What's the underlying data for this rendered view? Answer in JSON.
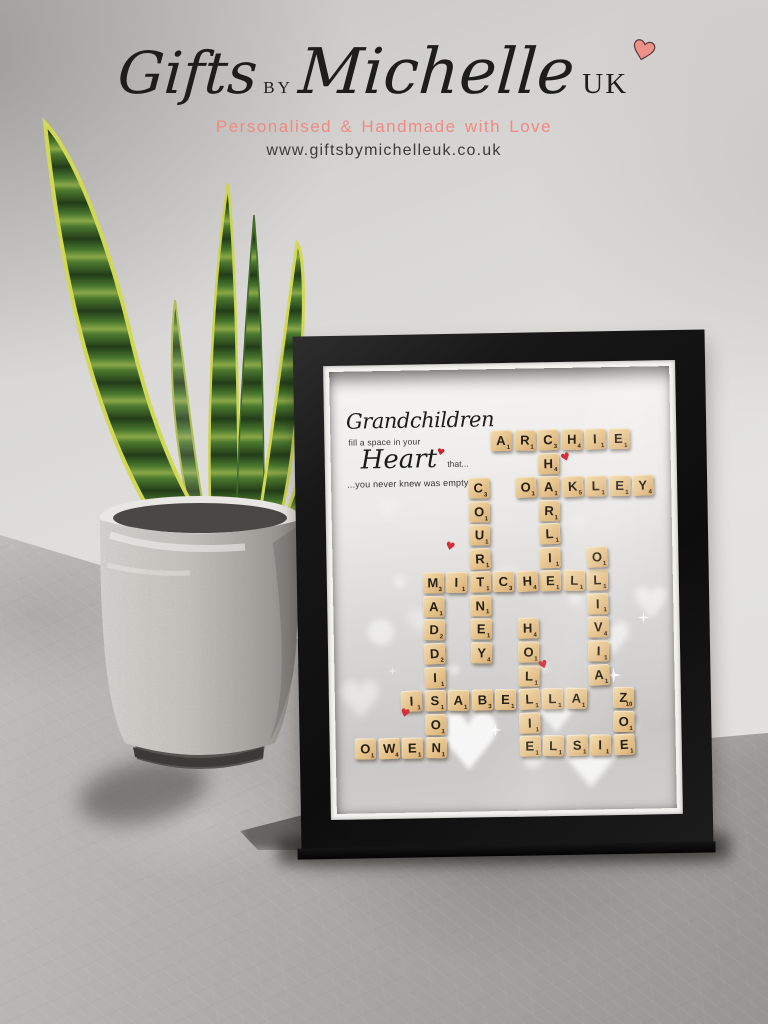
{
  "brand": {
    "logo_gifts": "Gifts",
    "logo_by": "BY",
    "logo_michelle": "Michelle",
    "logo_uk": "UK",
    "heart_color": "#ef9189",
    "tagline": "Personalised & Handmade with Love",
    "tagline_color": "#ef8b80",
    "website": "www.giftsbymichelleuk.co.uk"
  },
  "frame": {
    "quote": {
      "line1": "Grandchildren",
      "line2": "fill a space in your",
      "line3_word": "Heart",
      "line3_suffix": "that...",
      "line4": "...you never knew was empty"
    },
    "grid": {
      "origin_x": 19,
      "origin_y": 61,
      "pitch_x": 23.5,
      "pitch_y": 23.55
    },
    "words": [
      {
        "w": "ARCHIE",
        "d": "h",
        "r": 0,
        "c": 6,
        "t": [
          [
            "A",
            1
          ],
          [
            "R",
            1
          ],
          [
            "C",
            3
          ],
          [
            "H",
            4
          ],
          [
            "I",
            1
          ],
          [
            "E",
            1
          ]
        ]
      },
      {
        "w": "CHARLIE",
        "d": "v",
        "r": 0,
        "c": 8,
        "t": [
          [
            "C",
            3
          ],
          [
            "H",
            4
          ],
          [
            "A",
            1
          ],
          [
            "R",
            1
          ],
          [
            "L",
            1
          ],
          [
            "I",
            1
          ],
          [
            "E",
            1
          ]
        ]
      },
      {
        "w": "OAKLEY",
        "d": "h",
        "r": 2,
        "c": 7,
        "t": [
          [
            "O",
            1
          ],
          [
            "A",
            1
          ],
          [
            "K",
            5
          ],
          [
            "L",
            1
          ],
          [
            "E",
            1
          ],
          [
            "Y",
            4
          ]
        ]
      },
      {
        "w": "COURTNEY",
        "d": "v",
        "r": 2,
        "c": 5,
        "t": [
          [
            "C",
            3
          ],
          [
            "O",
            1
          ],
          [
            "U",
            1
          ],
          [
            "R",
            1
          ],
          [
            "T",
            1
          ],
          [
            "N",
            1
          ],
          [
            "E",
            1
          ],
          [
            "Y",
            4
          ]
        ]
      },
      {
        "w": "MITCHELL",
        "d": "h",
        "r": 6,
        "c": 3,
        "t": [
          [
            "M",
            3
          ],
          [
            "I",
            1
          ],
          [
            "T",
            1
          ],
          [
            "C",
            3
          ],
          [
            "H",
            4
          ],
          [
            "E",
            1
          ],
          [
            "L",
            1
          ],
          [
            "L",
            1
          ]
        ]
      },
      {
        "w": "OLIVIA",
        "d": "v",
        "r": 5,
        "c": 10,
        "t": [
          [
            "O",
            1
          ],
          [
            "L",
            1
          ],
          [
            "I",
            1
          ],
          [
            "V",
            4
          ],
          [
            "I",
            1
          ],
          [
            "A",
            1
          ]
        ]
      },
      {
        "w": "MADDISON",
        "d": "v",
        "r": 6,
        "c": 3,
        "t": [
          [
            "M",
            3
          ],
          [
            "A",
            1
          ],
          [
            "D",
            2
          ],
          [
            "D",
            2
          ],
          [
            "I",
            1
          ],
          [
            "S",
            1
          ],
          [
            "O",
            1
          ],
          [
            "N",
            1
          ]
        ]
      },
      {
        "w": "HOLLIE",
        "d": "v",
        "r": 8,
        "c": 7,
        "t": [
          [
            "H",
            4
          ],
          [
            "O",
            1
          ],
          [
            "L",
            1
          ],
          [
            "L",
            1
          ],
          [
            "I",
            1
          ],
          [
            "E",
            1
          ]
        ]
      },
      {
        "w": "ISABELLA",
        "d": "h",
        "r": 11,
        "c": 2,
        "t": [
          [
            "I",
            1
          ],
          [
            "S",
            1
          ],
          [
            "A",
            1
          ],
          [
            "B",
            3
          ],
          [
            "E",
            1
          ],
          [
            "L",
            1
          ],
          [
            "L",
            1
          ],
          [
            "A",
            1
          ]
        ]
      },
      {
        "w": "ZOE",
        "d": "v",
        "r": 11,
        "c": 11,
        "t": [
          [
            "Z",
            10
          ],
          [
            "O",
            1
          ],
          [
            "E",
            1
          ]
        ]
      },
      {
        "w": "OWEN",
        "d": "h",
        "r": 13,
        "c": 0,
        "t": [
          [
            "O",
            1
          ],
          [
            "W",
            4
          ],
          [
            "E",
            1
          ],
          [
            "N",
            1
          ]
        ]
      },
      {
        "w": "ELSIE",
        "d": "h",
        "r": 13,
        "c": 7,
        "t": [
          [
            "E",
            1
          ],
          [
            "L",
            1
          ],
          [
            "S",
            1
          ],
          [
            "I",
            1
          ],
          [
            "E",
            1
          ]
        ]
      }
    ],
    "red_hearts": [
      {
        "x": 230,
        "y": 84
      },
      {
        "x": 113,
        "y": 171
      },
      {
        "x": 204,
        "y": 291
      },
      {
        "x": 65,
        "y": 337
      }
    ],
    "bokeh": [
      {
        "t": "heart",
        "x": 137,
        "y": 374,
        "s": 78,
        "o": 0.85,
        "b": 2
      },
      {
        "t": "heart",
        "x": 224,
        "y": 344,
        "s": 58,
        "o": 0.7,
        "b": 2
      },
      {
        "t": "heart",
        "x": 258,
        "y": 399,
        "s": 64,
        "o": 0.8,
        "b": 3
      },
      {
        "t": "heart",
        "x": 281,
        "y": 272,
        "s": 46,
        "o": 0.55,
        "b": 3
      },
      {
        "t": "heart",
        "x": 320,
        "y": 238,
        "s": 44,
        "o": 0.5,
        "b": 3
      },
      {
        "t": "heart",
        "x": 28,
        "y": 330,
        "s": 52,
        "o": 0.45,
        "b": 4
      },
      {
        "t": "heart",
        "x": 88,
        "y": 252,
        "s": 34,
        "o": 0.35,
        "b": 4
      },
      {
        "t": "heart",
        "x": 178,
        "y": 210,
        "s": 30,
        "o": 0.3,
        "b": 4
      },
      {
        "t": "heart",
        "x": 58,
        "y": 140,
        "s": 26,
        "o": 0.22,
        "b": 4
      },
      {
        "t": "heart",
        "x": 248,
        "y": 158,
        "s": 26,
        "o": 0.22,
        "b": 4
      },
      {
        "t": "spark",
        "x": 279,
        "y": 308,
        "s": 16,
        "o": 0.9,
        "b": 0
      },
      {
        "t": "spark",
        "x": 310,
        "y": 251,
        "s": 12,
        "o": 0.8,
        "b": 0
      },
      {
        "t": "spark",
        "x": 160,
        "y": 361,
        "s": 13,
        "o": 0.85,
        "b": 0
      },
      {
        "t": "spark",
        "x": 298,
        "y": 120,
        "s": 10,
        "o": 0.5,
        "b": 0
      },
      {
        "t": "spark",
        "x": 58,
        "y": 300,
        "s": 9,
        "o": 0.5,
        "b": 0
      },
      {
        "t": "dot",
        "x": 47,
        "y": 261,
        "s": 26,
        "o": 0.5,
        "b": 3
      },
      {
        "t": "dot",
        "x": 97,
        "y": 321,
        "s": 16,
        "o": 0.5,
        "b": 3
      },
      {
        "t": "dot",
        "x": 197,
        "y": 391,
        "s": 18,
        "o": 0.55,
        "b": 3
      },
      {
        "t": "dot",
        "x": 297,
        "y": 361,
        "s": 12,
        "o": 0.5,
        "b": 2
      },
      {
        "t": "dot",
        "x": 67,
        "y": 211,
        "s": 12,
        "o": 0.4,
        "b": 3
      },
      {
        "t": "dot",
        "x": 242,
        "y": 231,
        "s": 14,
        "o": 0.4,
        "b": 3
      },
      {
        "t": "dot",
        "x": 120,
        "y": 300,
        "s": 10,
        "o": 0.45,
        "b": 2
      },
      {
        "t": "dot",
        "x": 30,
        "y": 380,
        "s": 14,
        "o": 0.5,
        "b": 3
      },
      {
        "t": "dot",
        "x": 210,
        "y": 300,
        "s": 8,
        "o": 0.4,
        "b": 2
      },
      {
        "t": "dot",
        "x": 150,
        "y": 250,
        "s": 8,
        "o": 0.3,
        "b": 2
      }
    ],
    "tile_color": "#e6c38c",
    "red_heart_color": "#d22f36"
  }
}
